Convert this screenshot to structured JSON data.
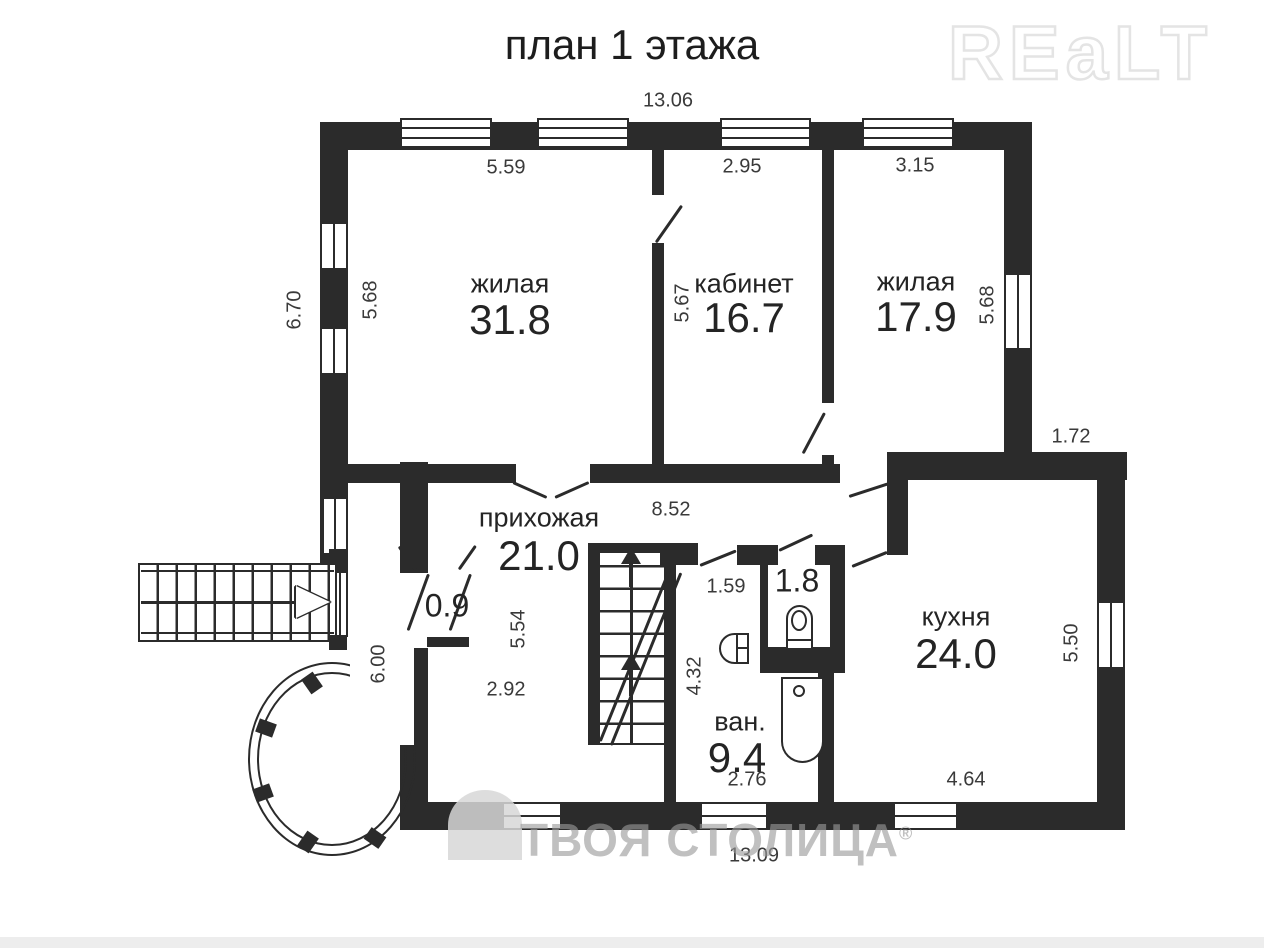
{
  "header": {
    "title": "план 1 этажа",
    "logo": "REaLT"
  },
  "watermark": {
    "text": "ТВОЯ СТОЛИЦА",
    "reg": "®"
  },
  "rooms": {
    "living1": {
      "name": "жилая",
      "area": "31.8"
    },
    "cabinet": {
      "name": "кабинет",
      "area": "16.7"
    },
    "living2": {
      "name": "жилая",
      "area": "17.9"
    },
    "hall": {
      "name": "прихожая",
      "area": "21.0"
    },
    "kitchen": {
      "name": "кухня",
      "area": "24.0"
    },
    "bath": {
      "name": "ван.",
      "area": "9.4"
    },
    "wc": {
      "area": "1.8"
    },
    "tambour": {
      "area": "0.9"
    }
  },
  "dims": {
    "top_width": "13.06",
    "bottom_width": "13.09",
    "living1_width": "5.59",
    "cabinet_width": "2.95",
    "living2_width": "3.15",
    "left_height_outer": "6.70",
    "living1_height": "5.68",
    "cabinet_height": "5.67",
    "living2_height": "5.68",
    "step_width": "1.72",
    "hall_width": "8.52",
    "bath_door_width": "1.59",
    "hall_height": "5.54",
    "hall_lower_width": "2.92",
    "left_lower_height": "6.00",
    "bath_height": "4.32",
    "bath_width": "2.76",
    "kitchen_width": "4.64",
    "kitchen_height": "5.50"
  },
  "colors": {
    "wall": "#2b2b2b",
    "text": "#3a3a3a",
    "logo_outline": "#e4e4e4",
    "watermark": "#9a9a9a"
  }
}
